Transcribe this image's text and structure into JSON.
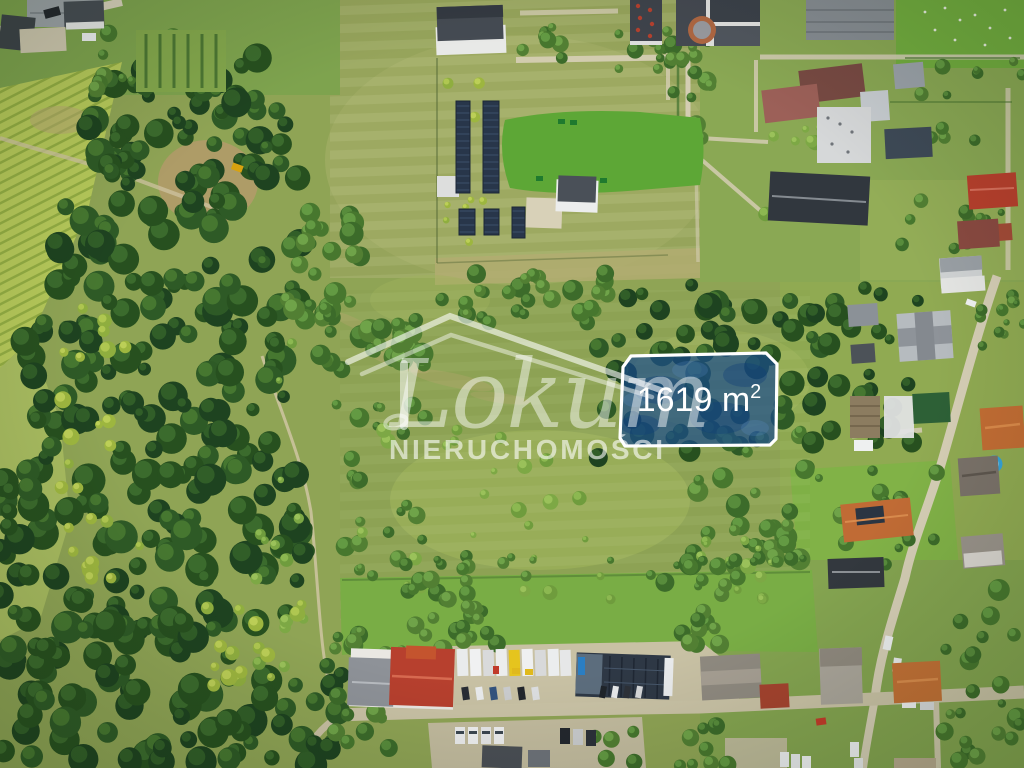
{
  "watermark": {
    "brand_script": "Lokum",
    "brand_caps": "NIERUCHOMOŚCI",
    "color": "#ffffff"
  },
  "plot_overlay": {
    "area_label": "1619 m²",
    "label_main": "1619 m",
    "label_superscript": "2",
    "fill_color": "#1d55a0",
    "border_color": "#ffffff",
    "text_color": "#ffffff"
  },
  "scene_palette": {
    "meadow_green": "#8fa455",
    "dry_field_green": "#9aa85e",
    "forest_green": "#2e5a26",
    "bright_lawn": "#5da736",
    "crop_field": "#b6c95a",
    "road_tan": "#d4cdb3",
    "roof_red": "#b7402e",
    "roof_orange": "#c26d34",
    "roof_dark": "#383e46",
    "solar_panel": "#28364a",
    "pool_blue": "#35a3d7"
  }
}
